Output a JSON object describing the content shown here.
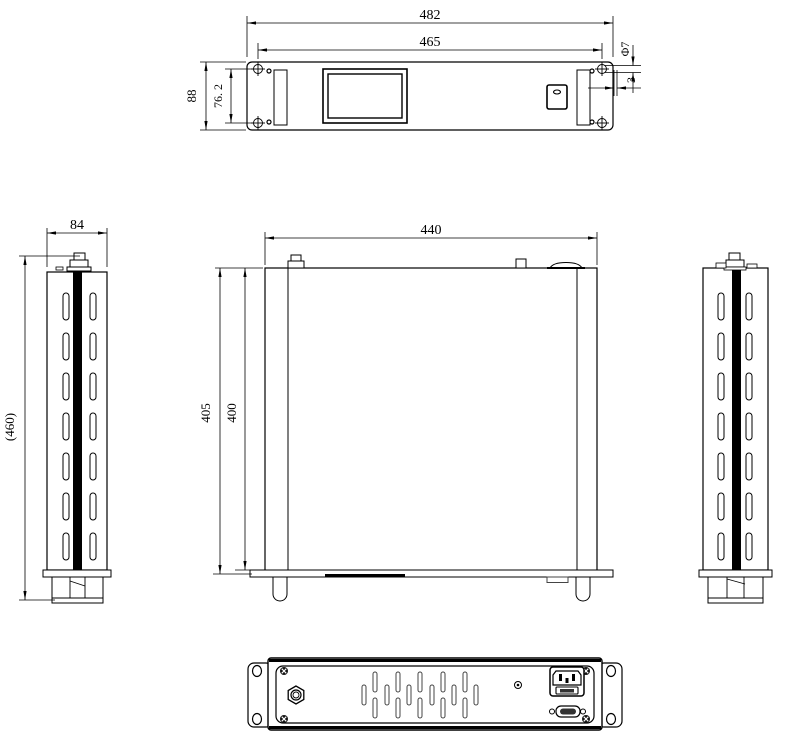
{
  "colors": {
    "line": "#000000",
    "background": "#ffffff",
    "stripe_fill": "#000000"
  },
  "views": {
    "front": {
      "dims": {
        "overall_width": "482",
        "mounting_width": "465",
        "overall_height": "88",
        "mounting_hole_spacing": "76. 2",
        "hole_diameter": "Φ7",
        "edge_offset": "3"
      }
    },
    "side_left": {
      "dims": {
        "width": "84",
        "overall_height_ref": "(460)"
      }
    },
    "top": {
      "dims": {
        "body_width": "440",
        "depth_overall": "405",
        "depth_body": "400"
      }
    },
    "side_right": {
      "dims": {}
    },
    "rear": {
      "dims": {}
    }
  }
}
